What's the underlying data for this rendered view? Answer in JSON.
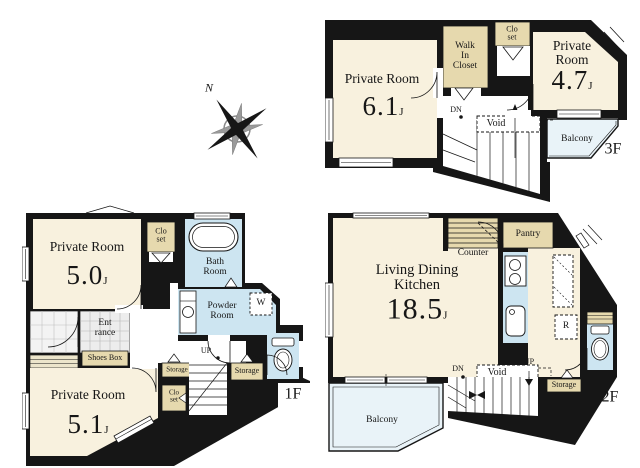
{
  "compass": {
    "north_label": "N"
  },
  "floor_3f": {
    "floor_label": "3F",
    "private_room_a": {
      "name": "Private Room",
      "area": "6.1",
      "area_unit": "J"
    },
    "private_room_b": {
      "name": "Private Room",
      "area": "4.7",
      "area_unit": "J"
    },
    "walk_in_closet_label": "Walk\nIn\nCloset",
    "closet_label": "Clo\nset",
    "down_label": "DN",
    "void_label": "Void",
    "balcony_label": "Balcony"
  },
  "floor_1f": {
    "floor_label": "1F",
    "private_room_a": {
      "name": "Private Room",
      "area": "5.0",
      "area_unit": "J"
    },
    "private_room_b": {
      "name": "Private Room",
      "area": "5.1",
      "area_unit": "J"
    },
    "closet_a_label": "Clo\nset",
    "closet_b_label": "Clo\nset",
    "bath_room_label": "Bath\nRoom",
    "powder_room_label": "Powder\nRoom",
    "washer_label": "W",
    "entrance_label": "Ent\nrance",
    "shoes_box_label": "Shoes Box",
    "storage_a_label": "Storage",
    "storage_b_label": "Storage",
    "up_label": "UP"
  },
  "floor_2f": {
    "floor_label": "2F",
    "living_dining_kitchen": {
      "name": "Living Dining\nKitchen",
      "area": "18.5",
      "area_unit": "J"
    },
    "counter_label": "Counter",
    "pantry_label": "Pantry",
    "refrigerator_label": "R",
    "storage_label": "Storage",
    "void_label": "Void",
    "down_label": "DN",
    "up_label": "UP",
    "balcony_label": "Balcony"
  },
  "colors": {
    "wall": "#161616",
    "room": "#f8f1de",
    "closet": "#e6d9ae",
    "wet_area": "#cde5f1",
    "balcony": "#e9f3f8"
  }
}
